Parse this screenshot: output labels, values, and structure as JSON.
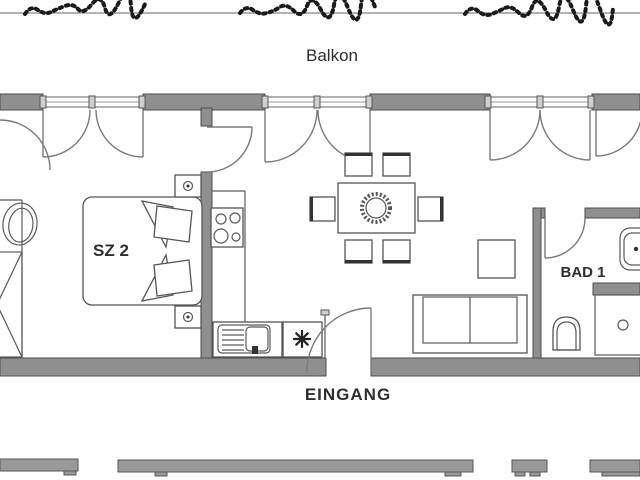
{
  "plan": {
    "type": "apartment-floor-plan",
    "labels": {
      "balcony": "Balkon",
      "bedroom_2": "SZ 2",
      "bathroom_1": "BAD 1",
      "entrance": "EINGANG"
    },
    "colors": {
      "wall_fill": "#8f8f8f",
      "wall_edge": "#4d4d4d",
      "line": "#5a5a5a",
      "text": "#2e2e2e",
      "background": "#ffffff"
    },
    "rooms": [
      {
        "id": "balcony",
        "label": "Balkon",
        "features": [
          "garden-edge-planting"
        ]
      },
      {
        "id": "bedroom-2",
        "label": "SZ 2",
        "furniture": [
          "double-bed",
          "pillow",
          "pillow",
          "nightstand-lamp",
          "nightstand-lamp"
        ]
      },
      {
        "id": "kitchen-living-dining",
        "label": "",
        "furniture": [
          "stove-4-burners",
          "kitchen-sink-unit",
          "appliance-star",
          "dining-table",
          "chair",
          "chair",
          "chair",
          "chair",
          "chair",
          "chair",
          "sofa-2-seat",
          "coffee-table"
        ]
      },
      {
        "id": "bathroom-1",
        "label": "BAD 1",
        "furniture": [
          "washbasin",
          "toilet",
          "shower-drain"
        ]
      },
      {
        "id": "bathroom-left-partial",
        "label": "",
        "furniture": [
          "washbasin",
          "shower"
        ]
      },
      {
        "id": "entrance",
        "label": "EINGANG",
        "features": [
          "entrance-door"
        ]
      }
    ]
  }
}
